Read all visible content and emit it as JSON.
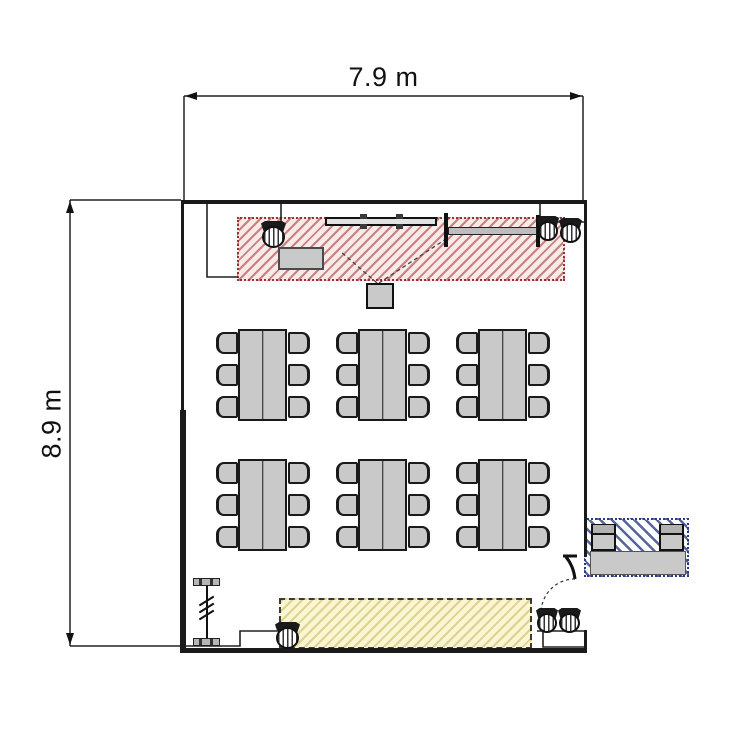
{
  "diagram": {
    "type": "room floor plan",
    "room_width_label": "7.9 m",
    "room_height_label": "8.9 m"
  },
  "colors": {
    "wall": "#1a1a1a",
    "furniture_fill": "#c9c9c9",
    "furniture_border": "#1a1a1a",
    "zone_red_bg": "#f9eaea",
    "zone_red_stripe": "#c98080",
    "zone_red_border": "#993333",
    "zone_yellow_bg": "#faf6d3",
    "zone_yellow_stripe": "#ddd28e",
    "zone_yellow_border": "#3a3a3a",
    "zone_blue_bg": "#ffffff",
    "zone_blue_stripe": "#57659b",
    "zone_blue_border": "#2c3a86"
  },
  "furniture": {
    "table_groups": [
      {
        "x": 215,
        "y": 329
      },
      {
        "x": 335,
        "y": 329
      },
      {
        "x": 455,
        "y": 329
      },
      {
        "x": 215,
        "y": 459
      },
      {
        "x": 335,
        "y": 459
      },
      {
        "x": 455,
        "y": 459
      }
    ],
    "seats_per_table_group": 6,
    "stools": [
      {
        "name": "stool-front-left",
        "x": 261,
        "y": 221,
        "w": 25,
        "h": 27
      },
      {
        "name": "stool-front-right-1",
        "x": 537,
        "y": 216,
        "w": 22,
        "h": 25
      },
      {
        "name": "stool-front-right-2",
        "x": 559,
        "y": 218,
        "w": 23,
        "h": 25
      },
      {
        "name": "stool-back-left",
        "x": 275,
        "y": 622,
        "w": 25,
        "h": 27
      },
      {
        "name": "stool-back-right-1",
        "x": 536,
        "y": 608,
        "w": 22,
        "h": 25
      },
      {
        "name": "stool-back-right-2",
        "x": 558,
        "y": 608,
        "w": 23,
        "h": 25
      }
    ]
  }
}
